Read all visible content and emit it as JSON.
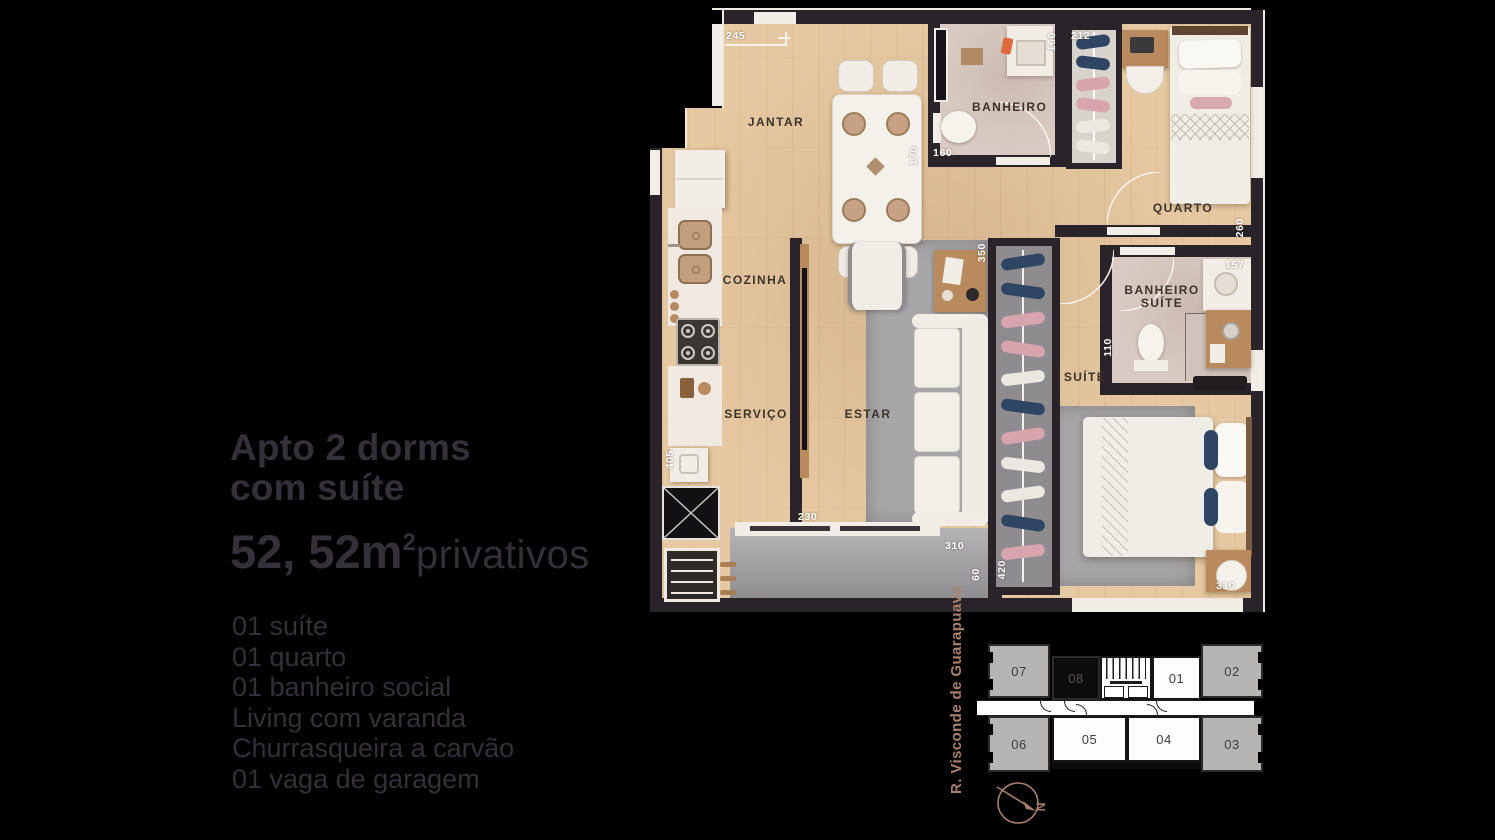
{
  "info_panel": {
    "title_line1": "Apto 2 dorms",
    "title_line2": "com suíte",
    "area_number": "52, 52m",
    "area_exponent": "2",
    "area_suffix": "privativos",
    "features": [
      "01 suíte",
      "01 quarto",
      "01 banheiro social",
      "Living com varanda",
      "Churrasqueira a carvão",
      "01 vaga de garagem"
    ]
  },
  "floor_plan": {
    "rooms": {
      "jantar": "JANTAR",
      "banheiro": "BANHEIRO",
      "quarto": "QUARTO",
      "cozinha": "COZINHA",
      "servico": "SERVIÇO",
      "estar": "ESTAR",
      "suite": "SUÍTE",
      "banheiro_suite_line1": "BANHEIRO",
      "banheiro_suite_line2": "SUÍTE"
    },
    "dimensions": {
      "entry_width": "245",
      "banheiro_depth": "160",
      "closet_quarto_width": "212",
      "jantar_width": "170",
      "banheiro_width": "160",
      "quarto_depth": "260",
      "banheiro_suite_width": "157",
      "closet_suite_top": "350",
      "banheiro_suite_depth": "110",
      "cozinha_length": "405",
      "varanda_door": "230",
      "varanda_width": "310",
      "varanda_depth": "60",
      "closet_suite_length": "420",
      "suite_width": "310"
    }
  },
  "key_plan": {
    "street_label": "R. Visconde de Guarapuava",
    "compass_label": "N",
    "highlighted_unit": "08",
    "units": {
      "u07": "07",
      "u08": "08",
      "u01": "01",
      "u02": "02",
      "u06": "06",
      "u05": "05",
      "u04": "04",
      "u03": "03"
    }
  },
  "colors": {
    "background": "#000000",
    "info_text": "#343039",
    "wood_floor": "#e6c9a2",
    "wall": "#2a242a",
    "street_text": "#a8806c",
    "highlight_unit_fill": "#0d0c0c"
  }
}
